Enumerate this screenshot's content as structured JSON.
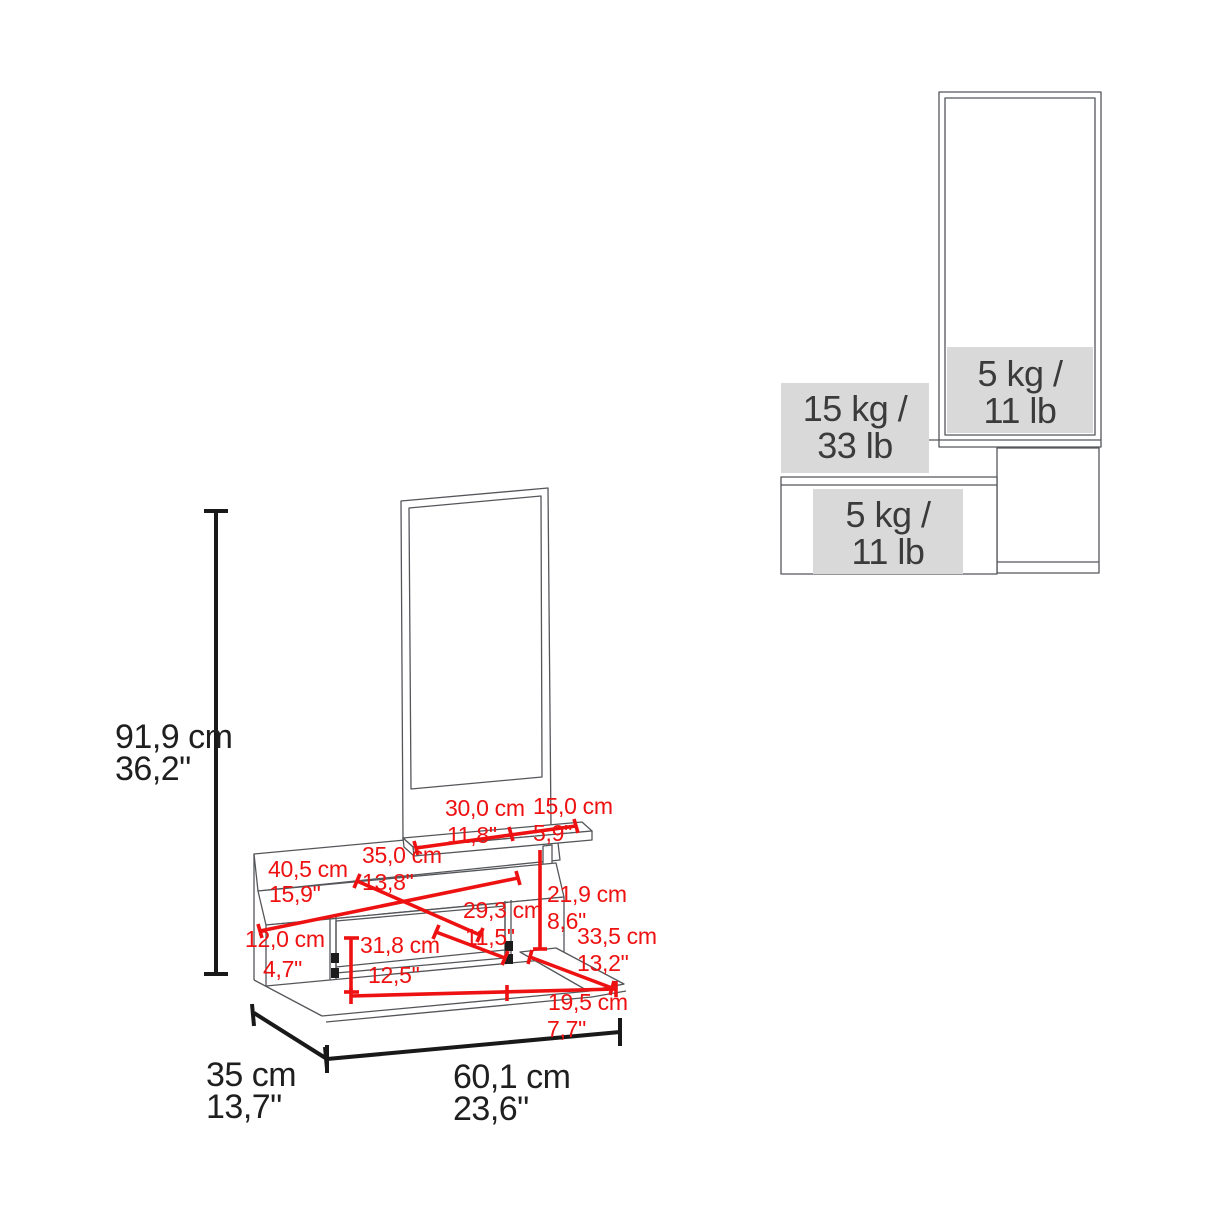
{
  "figure": {
    "kind": "furniture dimension and weight-capacity diagram",
    "views": [
      "front 3d wireframe with dimensions",
      "side view with load capacities"
    ]
  },
  "colors": {
    "dimension_red": "#ee1111",
    "dimension_black": "#191919",
    "wireframe_gray": "#54565a",
    "capacity_fill": "#d9d9d9",
    "capacity_text": "#3b3b3c"
  },
  "front_view": {
    "overall_dims": {
      "height": {
        "cm": "91,9 cm",
        "inch": "36,2\""
      },
      "depth": {
        "cm": "35 cm",
        "inch": "13,7\""
      },
      "width": {
        "cm": "60,1 cm",
        "inch": "23,6\""
      }
    },
    "part_dims": {
      "shelf_left": {
        "cm": "30,0 cm",
        "inch": "11,8\""
      },
      "shelf_right": {
        "cm": "15,0 cm",
        "inch": "5,9\""
      },
      "top_depth": {
        "cm": "35,0 cm",
        "inch": "13,8\""
      },
      "top_width": {
        "cm": "40,5 cm",
        "inch": "15,9\""
      },
      "shelf_gap_height": {
        "cm": "21,9 cm",
        "inch": "8,6\""
      },
      "compartment_depth": {
        "cm": "29,3 cm",
        "inch": "11,5\""
      },
      "lower_shelf_width": {
        "cm": "33,5 cm",
        "inch": "13,2\""
      },
      "compartment_height": {
        "cm": "12,0 cm",
        "inch": "4,7\""
      },
      "compartment_width": {
        "cm": "31,8 cm",
        "inch": "12,5\""
      },
      "lower_shelf_depth": {
        "cm": "19,5 cm",
        "inch": "7,7\""
      }
    }
  },
  "side_view": {
    "capacities": {
      "mirror_shelf": {
        "line1": "5 kg /",
        "line2": "11 lb"
      },
      "wall_shelf": {
        "line1": "15 kg /",
        "line2": "33 lb"
      },
      "cabinet": {
        "line1": "5 kg /",
        "line2": "11 lb"
      }
    }
  }
}
